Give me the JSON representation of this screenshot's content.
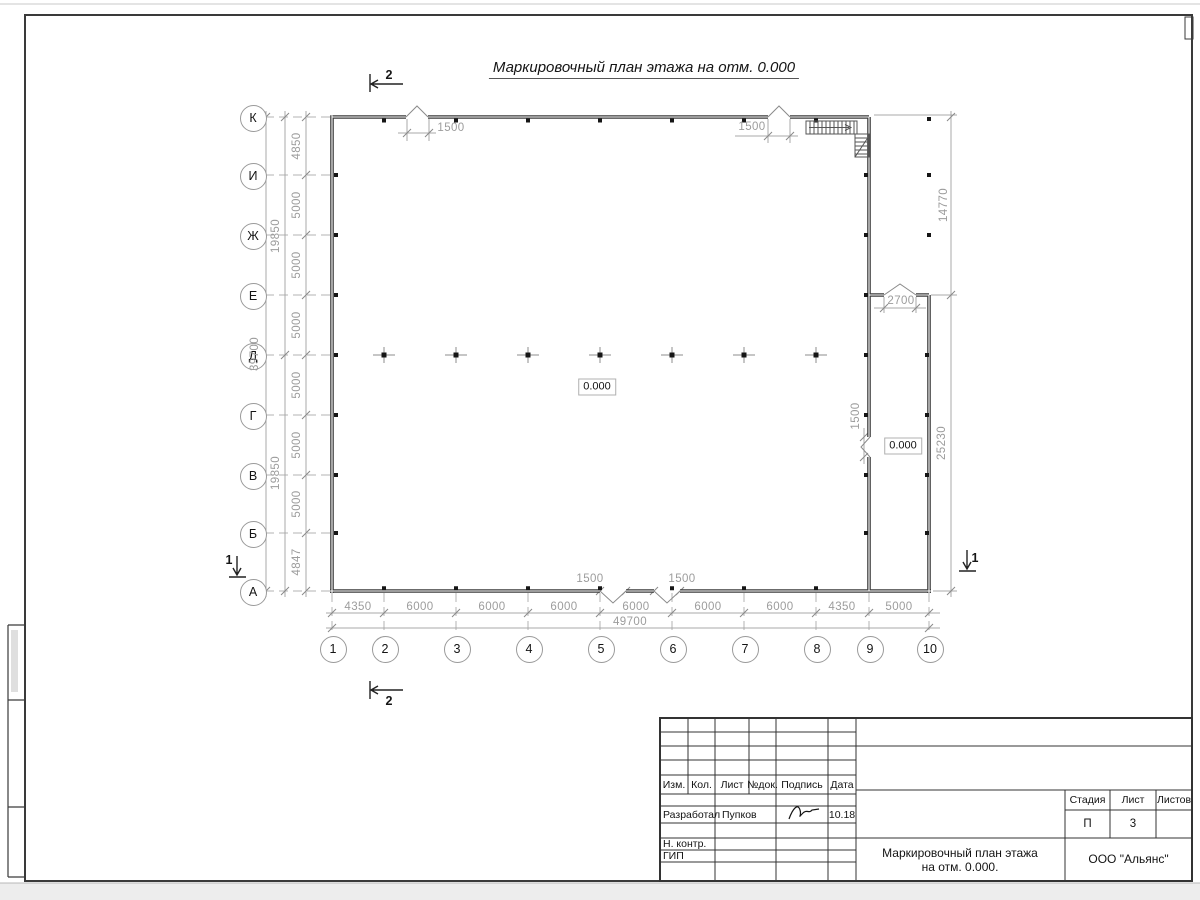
{
  "page": {
    "title": "Маркировочный план этажа на отм. 0.000"
  },
  "plan": {
    "row_axes": [
      "К",
      "И",
      "Ж",
      "Е",
      "Д",
      "Г",
      "В",
      "Б",
      "А"
    ],
    "col_axes": [
      "1",
      "2",
      "3",
      "4",
      "5",
      "6",
      "7",
      "8",
      "9",
      "10"
    ],
    "left_dims": {
      "segments": [
        "4850",
        "5000",
        "5000",
        "5000",
        "5000",
        "5000",
        "5000",
        "4847"
      ],
      "subtotals": [
        "19850",
        "19850"
      ],
      "total": "39700"
    },
    "bottom_dims": {
      "segments": [
        "4350",
        "6000",
        "6000",
        "6000",
        "6000",
        "6000",
        "6000",
        "4350",
        "5000"
      ],
      "total": "49700"
    },
    "right_dims": {
      "upper": "14770",
      "lower": "25230"
    },
    "openings": {
      "top_left": "1500",
      "top_right": "1500",
      "bottom_left": "1500",
      "bottom_right": "1500",
      "side": "1500",
      "extension_top": "2700"
    },
    "levels": {
      "main": "0.000",
      "extension": "0.000"
    },
    "sections": {
      "horizontal": "2",
      "vertical": "1"
    }
  },
  "titleblock": {
    "header_cols": [
      "Изм.",
      "Кол.",
      "Лист",
      "№док.",
      "Подпись",
      "Дата"
    ],
    "developed_label": "Разработал",
    "developed_name": "Пупков",
    "developed_date": "10.18",
    "ncontrol_label": "Н. контр.",
    "gip_label": "ГИП",
    "stage_label": "Стадия",
    "stage_value": "П",
    "sheet_label": "Лист",
    "sheet_value": "3",
    "sheets_label": "Листов",
    "sheets_value": "",
    "doc_title_line1": "Маркировочный план этажа",
    "doc_title_line2": "на отм. 0.000.",
    "company": "ООО \"Альянс\""
  },
  "colors": {
    "wall": "#3a3a3a",
    "thin_line": "#a8a8a8",
    "dim_text": "#9c9c9c",
    "frame": "#333333"
  }
}
